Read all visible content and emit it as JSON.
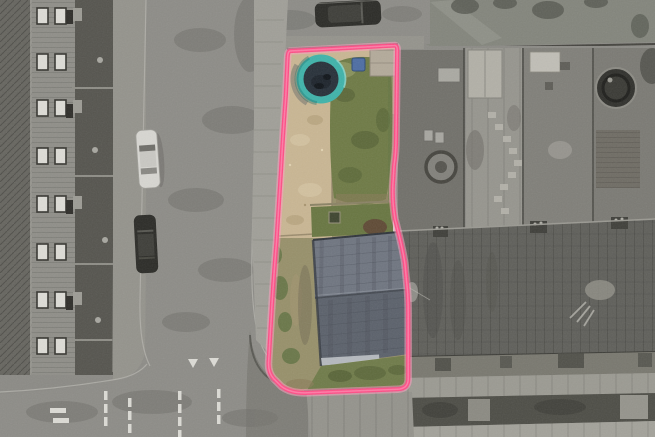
{
  "scene": {
    "kind": "aerial-drone-property-photo",
    "style": "greyscale streetscape with the listed plot shown in colour inside a pink boundary line"
  },
  "boundary": {
    "path": "M290,51 L394,45.5 Q397,45.2 397.2,49 L396,140 Q396,152 394,166 L392.8,186 Q392.2,202 395,219 L397.5,229 Q402.5,248 404.8,263 L407.4,290 Q408.2,300 408.2,313 L408.2,379 Q408.2,388.6 398,389.2 L308,392.8 Q291,393.6 281.5,386.5 L273.5,378.5 Q268,372.5 268.6,362 L272.2,301 Q274.4,267 276.4,243 L281.2,167 Q283.4,128 285.8,96 L287.6,57.5 Q287.9,51.6 290,51 Z",
    "stroke_width": "4.2"
  },
  "palette": {
    "boundary_pink": "#ff4d86",
    "boundary_glow": "#ff9fc0",
    "boundary_highlight": "#ff8fb4",
    "lawn_green": "#6e7a45",
    "lawn_dark": "#556336",
    "lawn_pale": "#9aa06b",
    "lawn_lower": "#687641",
    "grass_strip": "#6f7b49",
    "gravel_tan": "#c9b693",
    "gravel_light": "#dcccab",
    "gravel_dot": "#a8946f",
    "scrub_khaki": "#97906a",
    "scrub_green": "#627343",
    "dirt_brown": "#8a7a5a",
    "mud_patch": "#5f4a35",
    "roof_slate_upper": "#6f7580",
    "roof_slate_lower": "#5b616b",
    "roof_streak": "#484d56",
    "gutter_light": "#bfc3c8",
    "trampoline_ring": "#3fb3aa",
    "trampoline_mat": "#273039",
    "bin_blue": "#4d6da3",
    "curb_red": "#a4654e",
    "road_grey": "#8d8c87",
    "road_dark": "#73726d",
    "apron_dark": "#7b7a74",
    "sidewalk_grey": "#a09f98",
    "sidewalk_dim": "#94938c",
    "house_roof_grey": "#66655f",
    "facade_grey": "#8f8e88",
    "yard_dark": "#55544e",
    "field_grey": "#83857c",
    "shadow_grey": "#565850",
    "garden_grey": "#8b8a85",
    "garden_dark": "#6e6d67",
    "terrace_roof_grey": "#5f5f5a",
    "hedge_dark": "#4d4d46",
    "marking_white": "#dcdbd5",
    "car_white": "#d7d6d1",
    "car_dark": "#2b2b27",
    "car_roof_dark": "#3e3e39",
    "shed_light": "#b2b0a7",
    "pool_dark": "#30302c",
    "window_white": "#dddcd6",
    "window_glass": "#35342f",
    "wall_line": "#45443f",
    "paving_grey": "#9b9a92"
  },
  "objects": {
    "plot": [
      "garden-lawn",
      "gravel-patio",
      "trampoline",
      "wheelie-bin",
      "patio-slab",
      "rear-scrub-strip",
      "house-roof",
      "red-brick-kerb"
    ],
    "surroundings": [
      "terraced-houses",
      "street",
      "pavement",
      "parked-cars",
      "give-way-markings",
      "neighbour-gardens",
      "garden-sheds",
      "round-pools",
      "terrace-roof",
      "hedge-row",
      "grass-field"
    ]
  }
}
